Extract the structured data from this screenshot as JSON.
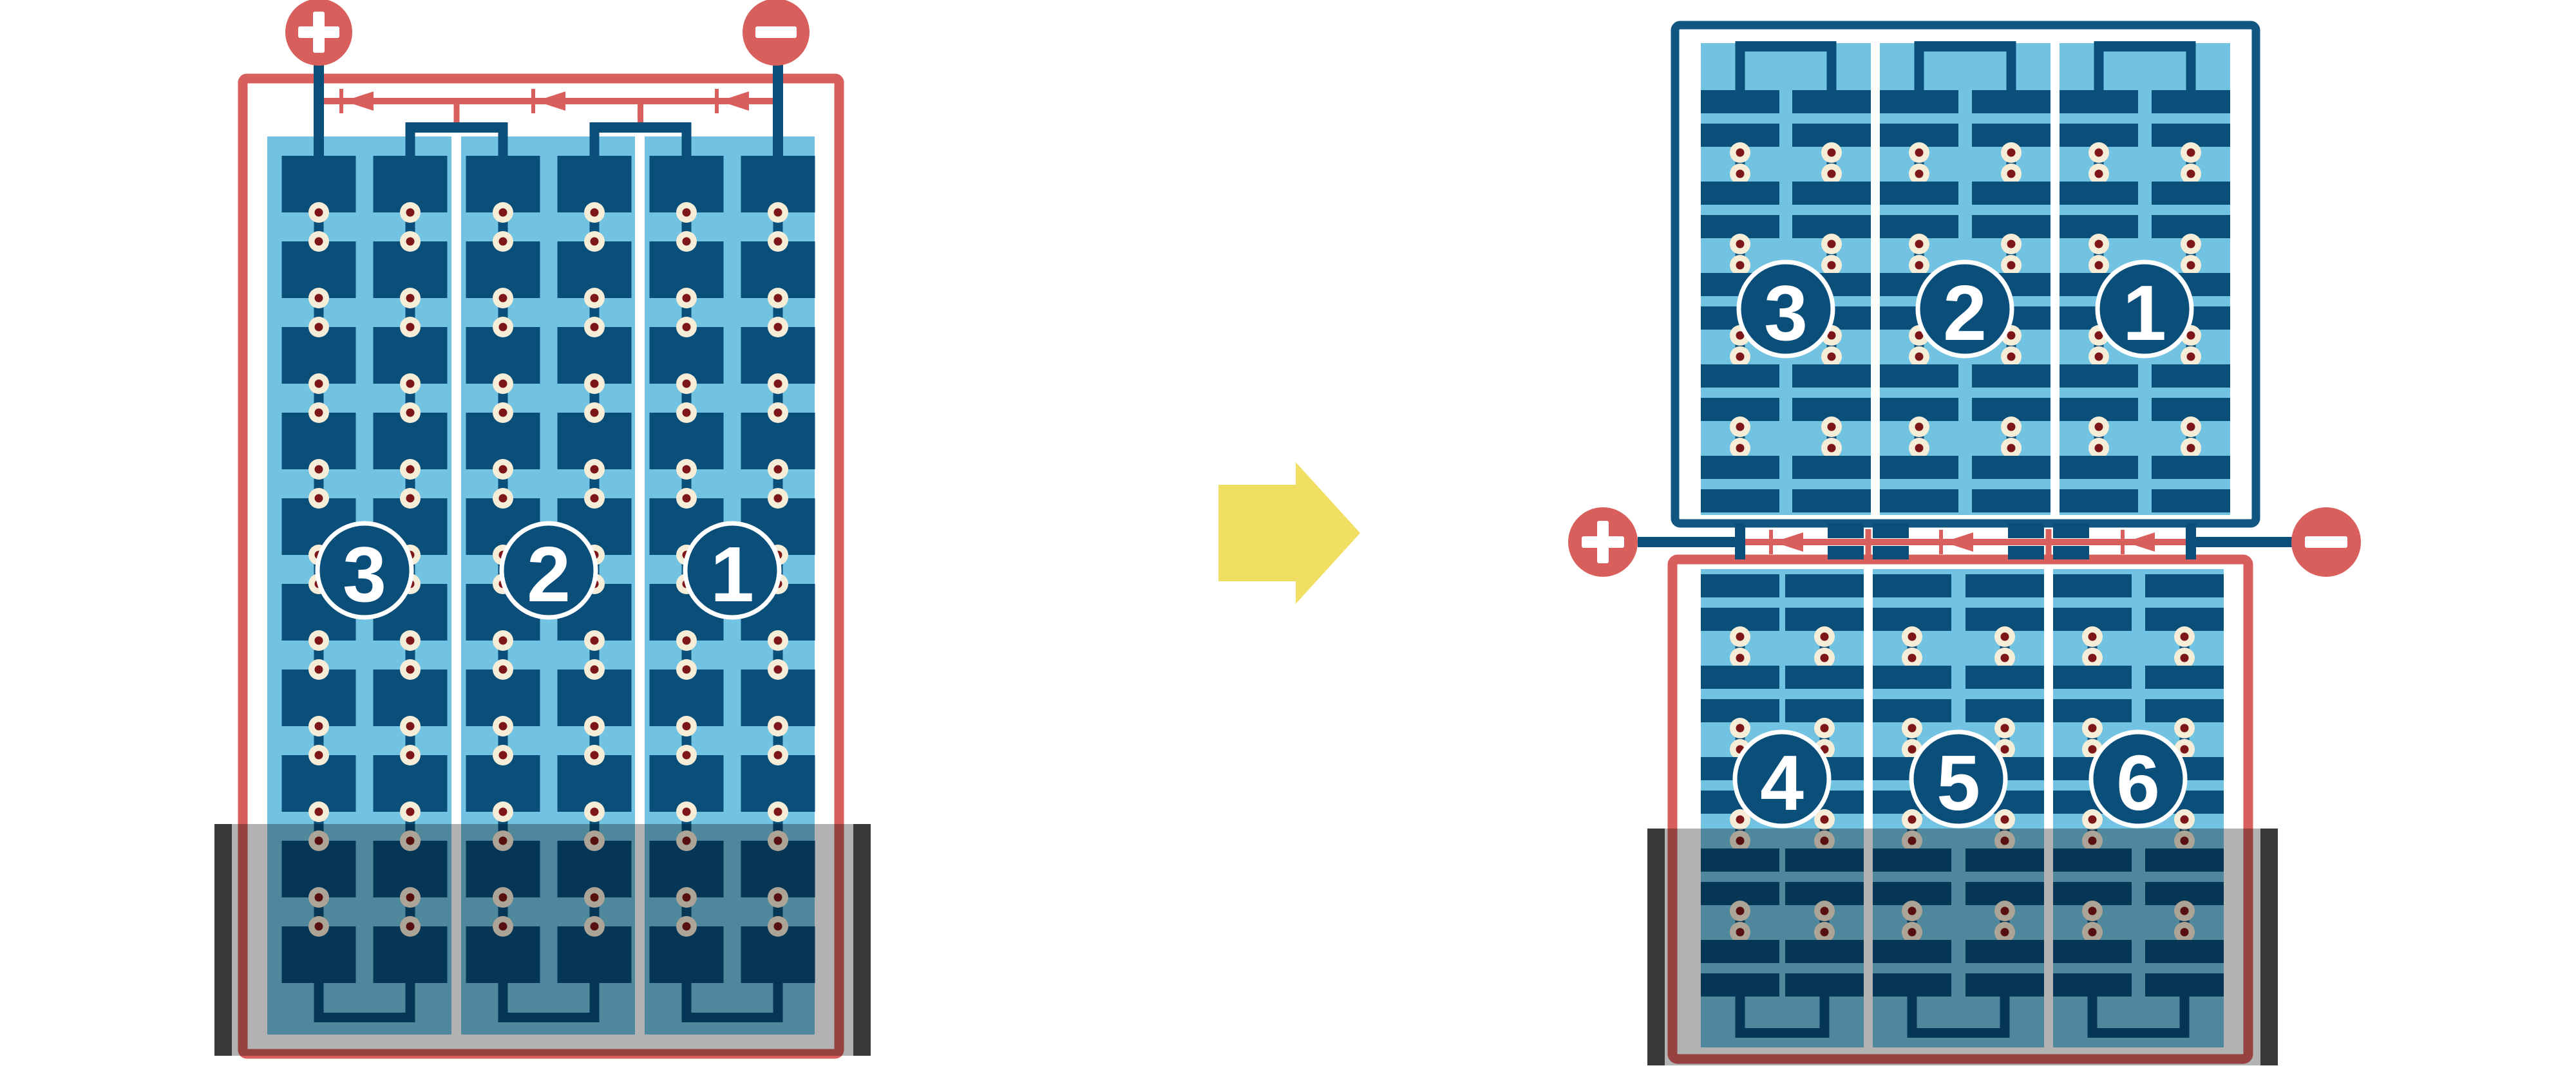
{
  "colors": {
    "cell_navy": "#0A4E7A",
    "frame_navy": "#115681",
    "panel_light_blue": "#72C3E1",
    "wire_red": "#D95F5C",
    "solder_dot_cream": "#F6EDD8",
    "solder_dot_dark_red": "#7D1618",
    "arrow_yellow": "#F1DF63",
    "shade_bar_charcoal": "#3A3938",
    "shade_overlay": "rgba(0,0,0,0.30)",
    "background": "#FFFFFF"
  },
  "left_module": {
    "string_labels": [
      "3",
      "2",
      "1"
    ],
    "terminals": {
      "positive": "+",
      "negative": "−"
    },
    "string_count": 3,
    "cell_columns_per_string": 2,
    "cell_rows": 10,
    "bypass_diode_count": 3
  },
  "right_module": {
    "top_string_labels": [
      "3",
      "2",
      "1"
    ],
    "bottom_string_labels": [
      "4",
      "5",
      "6"
    ],
    "terminals": {
      "positive": "+",
      "negative": "−"
    },
    "string_count": 6,
    "half_cell_row_pairs_per_half": 5,
    "bypass_diode_count": 3
  },
  "transition_arrow": {
    "direction": "right"
  }
}
